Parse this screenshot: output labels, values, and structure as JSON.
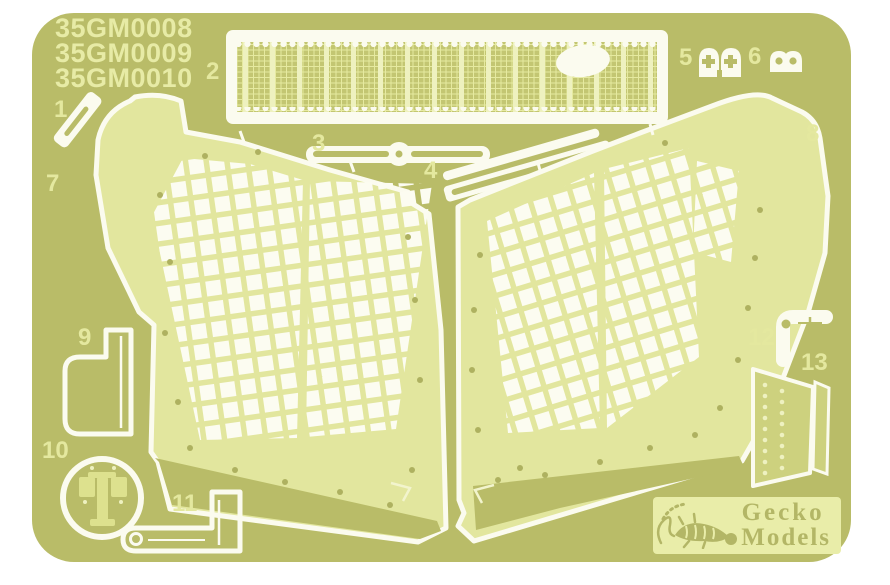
{
  "sheet": {
    "description": "photo-etched metal fret",
    "product_codes": [
      "35GM0008",
      "35GM0009",
      "35GM0010"
    ],
    "part_numbers": {
      "p1": "1",
      "p2": "2",
      "p3": "3",
      "p4": "4",
      "p5": "5",
      "p6": "6",
      "p7": "7",
      "p8": "8",
      "p9": "9",
      "p10": "10",
      "p11": "11",
      "p12": "12",
      "p13": "13"
    },
    "colors": {
      "background": "#ffffff",
      "fret_brass": "#b9bc68",
      "panel_light": "#e2e69e",
      "etched_white": "#fbfbef",
      "label_cream": "#e4e89f",
      "mesh_interior": "#c3c672",
      "logo_plate": "#e9eda9",
      "logo_ink": "#b3b666"
    }
  },
  "logo": {
    "line1": "Gecko",
    "line2": "Models"
  }
}
